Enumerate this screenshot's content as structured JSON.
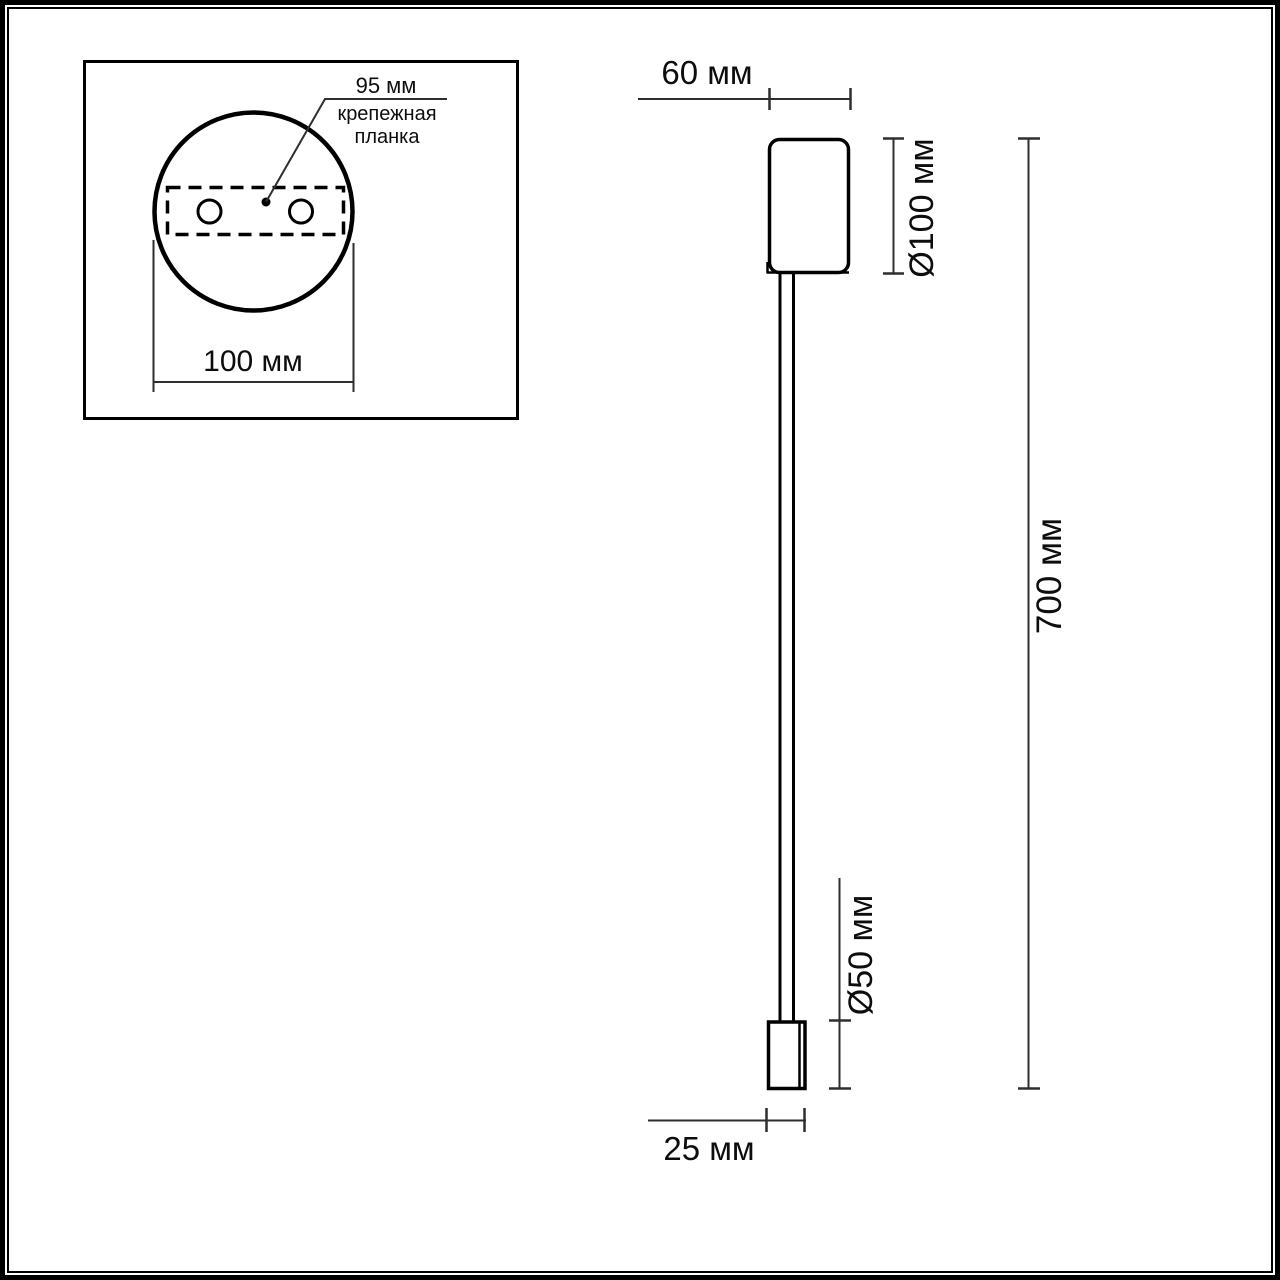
{
  "colors": {
    "line": "#000000",
    "dim_line": "#2e2e2e",
    "background": "#ffffff"
  },
  "inset": {
    "bracket_width_label": "95 мм",
    "bracket_name": "крепежная\nпланка",
    "plate_width_label": "100 мм"
  },
  "side_view": {
    "mount_depth_label": "60 мм",
    "mount_diameter_label": "Ø100 мм",
    "overall_height_label": "700 мм",
    "tip_diameter_label": "Ø50 мм",
    "tip_width_label": "25 мм"
  }
}
